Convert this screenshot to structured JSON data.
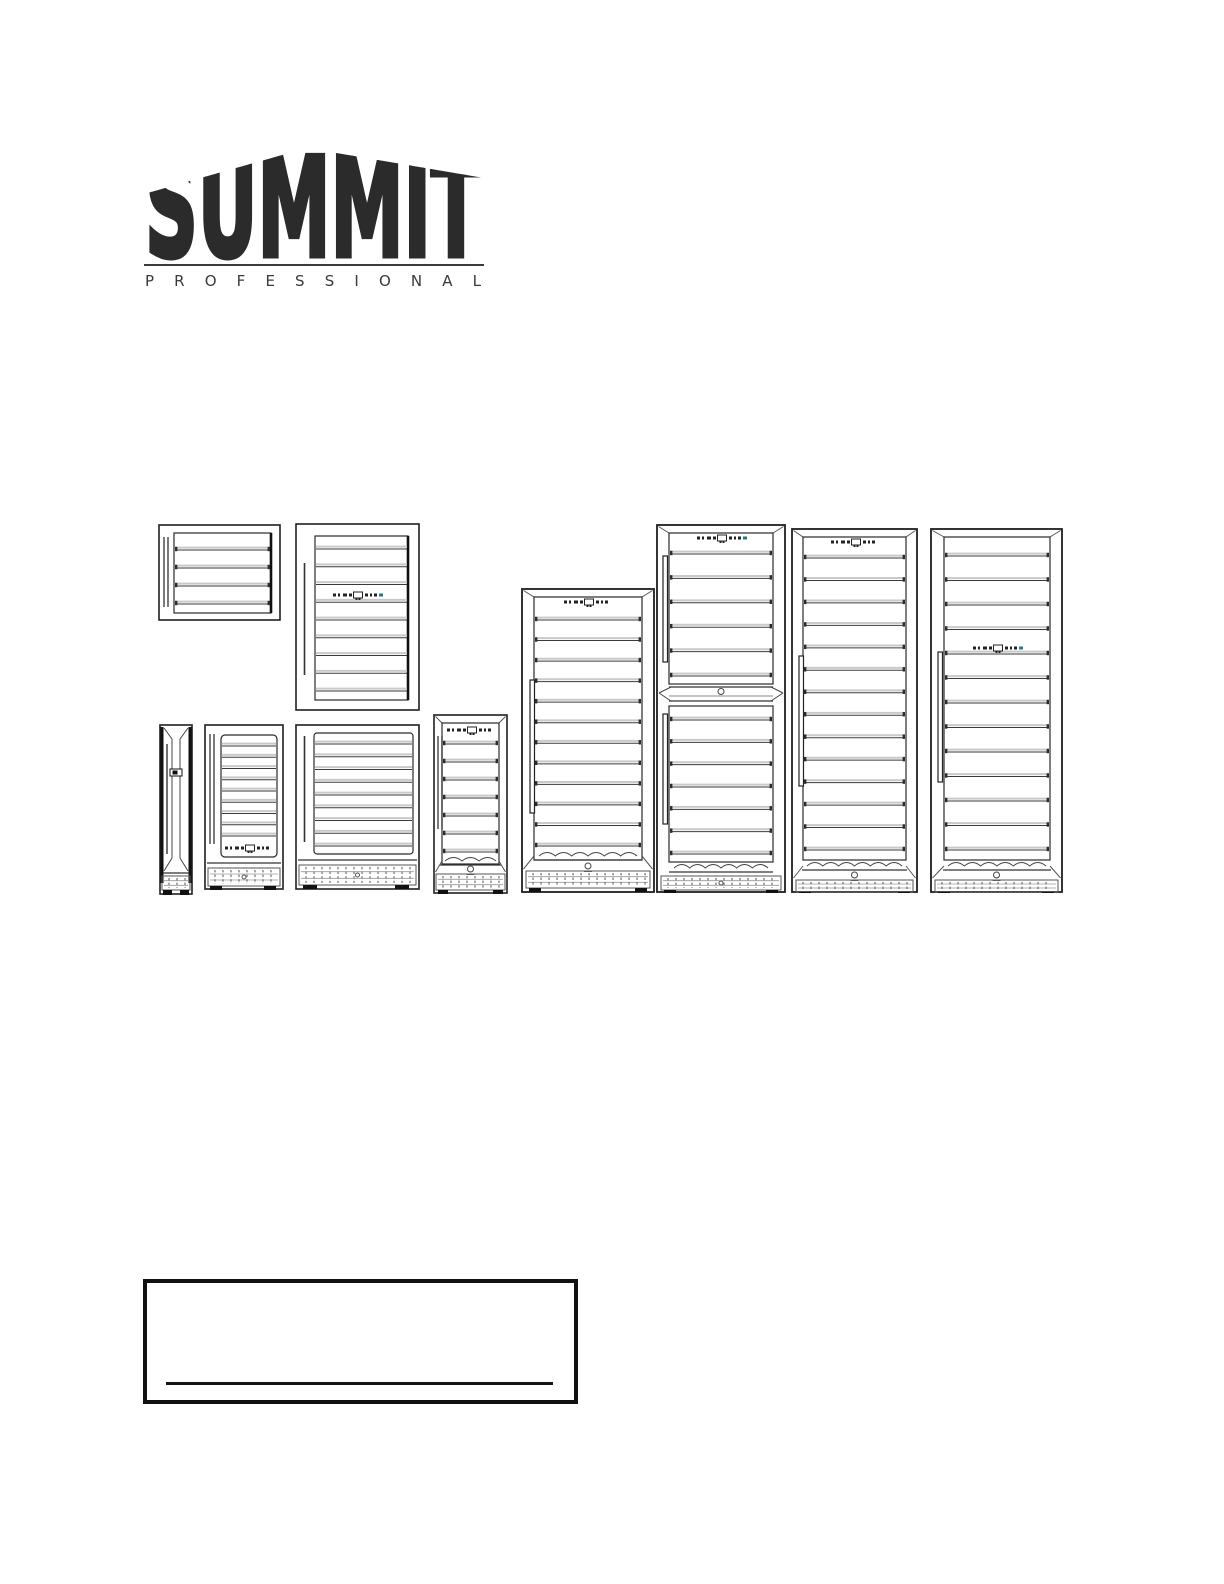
{
  "page": {
    "background": "#ffffff",
    "ink": "#1f1f1f"
  },
  "logo": {
    "brand": "SUMMIT",
    "subtitle": "PROFESSIONAL",
    "color": "#2b2b2b"
  },
  "figures": {
    "accent_teal": "#1b7f7b",
    "shelf_dark": "#3a3a3a",
    "shelf_light": "#c9c9c9",
    "units": [
      {
        "name": "shallow-beverage-center-front",
        "x": 158,
        "y": 524,
        "w": 123,
        "h": 97,
        "frame": {
          "sw": 1.6
        },
        "handle": {
          "kind": "double",
          "x": 6,
          "y1": 13,
          "y2": 83
        },
        "door": {
          "x1": 16,
          "y1": 9,
          "x2": 113,
          "y2": 89,
          "rightBold": true
        },
        "shelves": {
          "x1": 17,
          "x2": 112,
          "y1": 26,
          "y2": 80,
          "count": 4,
          "ticks": true
        }
      },
      {
        "name": "compact-wine-cellar-front",
        "x": 295,
        "y": 523,
        "w": 125,
        "h": 188,
        "frame": {
          "sw": 1.6
        },
        "handle": {
          "kind": "single",
          "x": 9,
          "y1": 40,
          "y2": 152
        },
        "door": {
          "x1": 20,
          "y1": 13,
          "x2": 113,
          "y2": 177,
          "rightBold": true
        },
        "shelves": {
          "x1": 21,
          "x2": 112,
          "y1": 26,
          "y2": 168,
          "count": 9,
          "ticks": false
        },
        "control": {
          "cx": 62,
          "cy": 72,
          "teal": true
        }
      },
      {
        "name": "slim-wine-column-side",
        "x": 159,
        "y": 724,
        "w": 34,
        "h": 171,
        "slim": true
      },
      {
        "name": "undercounter-wine-cooler-front",
        "x": 204,
        "y": 724,
        "w": 80,
        "h": 166,
        "frame": {
          "sw": 1.6
        },
        "handle": {
          "kind": "double",
          "x": 6,
          "y1": 10,
          "y2": 120
        },
        "door": {
          "x1": 17,
          "y1": 11,
          "x2": 73,
          "y2": 133,
          "rx": 4
        },
        "shelves": {
          "x1": 18,
          "x2": 72,
          "y1": 22,
          "y2": 112,
          "count": 9,
          "ticks": false
        },
        "control": {
          "cx": 45,
          "cy": 124,
          "teal": false
        },
        "plinth": {
          "y": 139
        },
        "grille": {
          "x1": 4,
          "y1": 144,
          "x2": 76,
          "y2": 162,
          "dot": true
        },
        "feet": [
          [
            6,
            162,
            12,
            4
          ],
          [
            60,
            162,
            12,
            4
          ]
        ]
      },
      {
        "name": "built-in-wine-cellar-front",
        "x": 295,
        "y": 724,
        "w": 125,
        "h": 166,
        "frame": {
          "sw": 1.6
        },
        "handle": {
          "kind": "single",
          "x": 9,
          "y1": 12,
          "y2": 118
        },
        "door": {
          "x1": 19,
          "y1": 9,
          "x2": 118,
          "y2": 130,
          "rx": 3
        },
        "shelves": {
          "x1": 20,
          "x2": 117,
          "y1": 20,
          "y2": 122,
          "count": 9,
          "ticks": false
        },
        "plinth": {
          "y": 136
        },
        "grille": {
          "x1": 4,
          "y1": 141,
          "x2": 121,
          "y2": 161,
          "dot": true
        },
        "feet": [
          [
            8,
            161,
            14,
            4
          ],
          [
            100,
            161,
            14,
            4
          ]
        ]
      },
      {
        "name": "slim-tall-wine-cellar-front",
        "x": 433,
        "y": 714,
        "w": 75,
        "h": 180,
        "frame": {
          "sw": 1.6
        },
        "bevelTop": true,
        "bevelBottom": true,
        "door": {
          "x1": 9,
          "y1": 9,
          "x2": 66,
          "y2": 150
        },
        "control": {
          "cx": 38,
          "cy": 16,
          "teal": false
        },
        "handle": {
          "kind": "double",
          "x": 5,
          "y1": 22,
          "y2": 115
        },
        "shelves": {
          "x1": 10,
          "x2": 65,
          "y1": 30,
          "y2": 138,
          "count": 7,
          "ticks": true
        },
        "wavy": {
          "x1": 12,
          "x2": 63,
          "y": 147,
          "lock": true,
          "locky": 155
        },
        "grille": {
          "x1": 3,
          "y1": 160,
          "x2": 72,
          "y2": 176,
          "dot": false
        },
        "feet": [
          [
            5,
            176,
            10,
            4
          ],
          [
            60,
            176,
            10,
            4
          ]
        ]
      },
      {
        "name": "tall-wine-cellar-single-zone-front",
        "x": 521,
        "y": 588,
        "w": 134,
        "h": 305,
        "frame": {
          "sw": 1.8
        },
        "bevelTop": true,
        "bevelBottom": true,
        "door": {
          "x1": 13,
          "y1": 9,
          "x2": 121,
          "y2": 272
        },
        "control": {
          "cx": 67,
          "cy": 14,
          "teal": false
        },
        "handle": {
          "kind": "bar",
          "x": 9,
          "y1": 92,
          "y2": 225
        },
        "shelves": {
          "x1": 14,
          "x2": 120,
          "y1": 32,
          "y2": 258,
          "count": 12,
          "ticks": true
        },
        "wavy": {
          "x1": 18,
          "x2": 116,
          "y": 268,
          "lock": true,
          "locky": 278
        },
        "grille": {
          "x1": 5,
          "y1": 283,
          "x2": 129,
          "y2": 300,
          "dot": false
        },
        "feet": [
          [
            8,
            300,
            12,
            4
          ],
          [
            114,
            300,
            12,
            4
          ]
        ]
      },
      {
        "name": "dual-zone-wine-cellar-front",
        "x": 656,
        "y": 524,
        "w": 130,
        "h": 369,
        "frame": {
          "sw": 1.8
        },
        "bevelTop": true,
        "control": {
          "cx": 65,
          "cy": 14,
          "teal": true
        },
        "door": {
          "x1": 13,
          "y1": 9,
          "x2": 117,
          "y2": 160
        },
        "shelves": {
          "x1": 14,
          "x2": 116,
          "y1": 30,
          "y2": 152,
          "count": 6,
          "ticks": true
        },
        "handle": {
          "kind": "bar",
          "x": 7,
          "y1": 32,
          "y2": 138
        },
        "divider": {
          "y": 170,
          "lock": true
        },
        "door2": {
          "x1": 13,
          "y1": 182,
          "x2": 117,
          "y2": 338
        },
        "shelves2": {
          "x1": 14,
          "x2": 116,
          "y1": 196,
          "y2": 330,
          "count": 7,
          "ticks": true
        },
        "handle2": {
          "kind": "bar",
          "x": 7,
          "y1": 190,
          "y2": 300
        },
        "wavy": {
          "x1": 18,
          "x2": 112,
          "y": 344,
          "lock": false
        },
        "grille": {
          "x1": 5,
          "y1": 352,
          "x2": 125,
          "y2": 366,
          "dot": true
        },
        "feet": [
          [
            8,
            366,
            12,
            3
          ],
          [
            110,
            366,
            12,
            3
          ]
        ]
      },
      {
        "name": "tall-wine-cellar-top-control-front",
        "x": 791,
        "y": 528,
        "w": 127,
        "h": 365,
        "frame": {
          "sw": 1.8
        },
        "bevelTop": true,
        "bevelBottom": true,
        "control": {
          "cx": 64,
          "cy": 14,
          "teal": false
        },
        "door": {
          "x1": 12,
          "y1": 9,
          "x2": 115,
          "y2": 332
        },
        "shelves": {
          "x1": 13,
          "x2": 114,
          "y1": 30,
          "y2": 322,
          "count": 14,
          "ticks": true
        },
        "handle": {
          "kind": "bar",
          "x": 8,
          "y1": 128,
          "y2": 258
        },
        "wavy": {
          "x1": 16,
          "x2": 111,
          "y": 338,
          "lock": true,
          "locky": 347
        },
        "grille": {
          "x1": 5,
          "y1": 352,
          "x2": 122,
          "y2": 364,
          "dot": false
        },
        "feet": [
          [
            8,
            364,
            12,
            3
          ],
          [
            107,
            364,
            12,
            3
          ]
        ]
      },
      {
        "name": "tall-wine-cellar-mid-control-front",
        "x": 930,
        "y": 528,
        "w": 133,
        "h": 365,
        "frame": {
          "sw": 1.8
        },
        "bevelTop": true,
        "bevelBottom": true,
        "door": {
          "x1": 14,
          "y1": 9,
          "x2": 120,
          "y2": 332
        },
        "control": {
          "cx": 67,
          "cy": 120,
          "teal": true
        },
        "shelves": {
          "x1": 15,
          "x2": 119,
          "y1": 28,
          "y2": 322,
          "count": 13,
          "ticks": true
        },
        "handle": {
          "kind": "bar",
          "x": 8,
          "y1": 124,
          "y2": 254
        },
        "wavy": {
          "x1": 18,
          "x2": 116,
          "y": 338,
          "lock": true,
          "locky": 347
        },
        "grille": {
          "x1": 5,
          "y1": 352,
          "x2": 128,
          "y2": 364,
          "dot": false
        },
        "feet": [
          [
            8,
            364,
            12,
            3
          ],
          [
            112,
            364,
            12,
            3
          ]
        ]
      }
    ]
  },
  "footer_box": {
    "line_present": true
  }
}
